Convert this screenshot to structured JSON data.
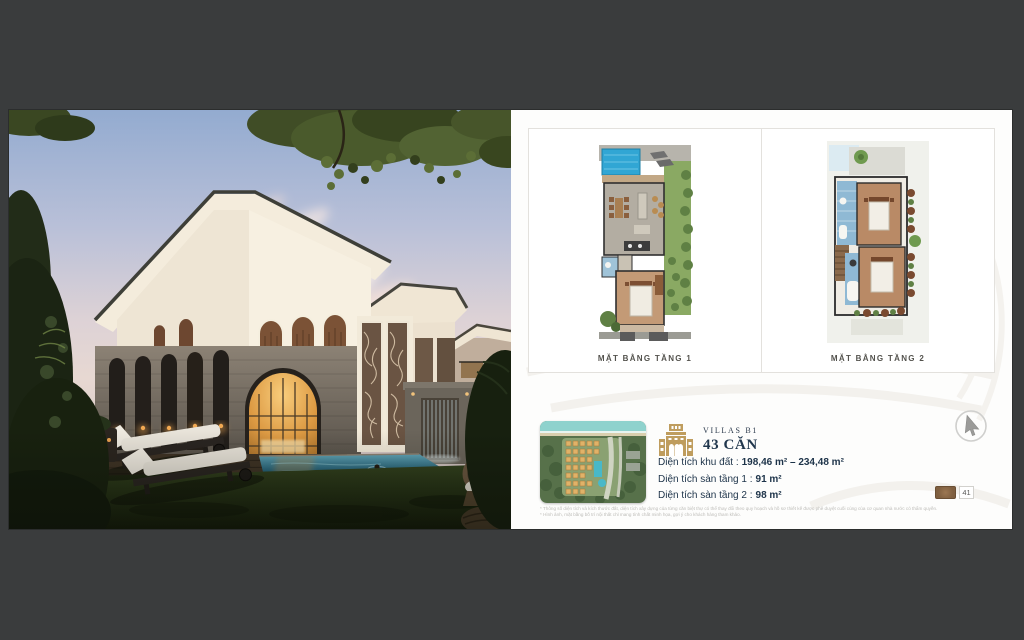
{
  "plans": {
    "floor1_label": "MẶT BẰNG TẦNG 1",
    "floor2_label": "MẶT BẰNG TẦNG 2"
  },
  "villa": {
    "series_label": "VILLAS B1",
    "units_label": "43 CĂN",
    "specs": [
      {
        "label": "Diện tích khu đất :",
        "value": "198,46 m² – 234,48 m²"
      },
      {
        "label": "Diện tích sàn tầng 1 :",
        "value": "91 m²"
      },
      {
        "label": "Diện tích sàn tầng 2 :",
        "value": "98 m²"
      }
    ],
    "disclaimers": [
      "* Thông số diện tích và kích thước đất, diện tích xây dựng của từng căn biệt thự có thể thay đổi theo quy hoạch và hồ sơ thiết kế được phê duyệt cuối cùng của cơ quan nhà nước có thẩm quyền.",
      "* Hình ảnh, mặt bằng bố trí nội thất chỉ mang tính chất minh họa, gợi ý cho khách hàng tham khảo."
    ]
  },
  "page": {
    "number": "41"
  },
  "colors": {
    "background": "#3a3c3d",
    "accent_gold": "#bf9d5e",
    "text_navy": "#1d3349",
    "pool_blue": "#2ea3d2"
  }
}
